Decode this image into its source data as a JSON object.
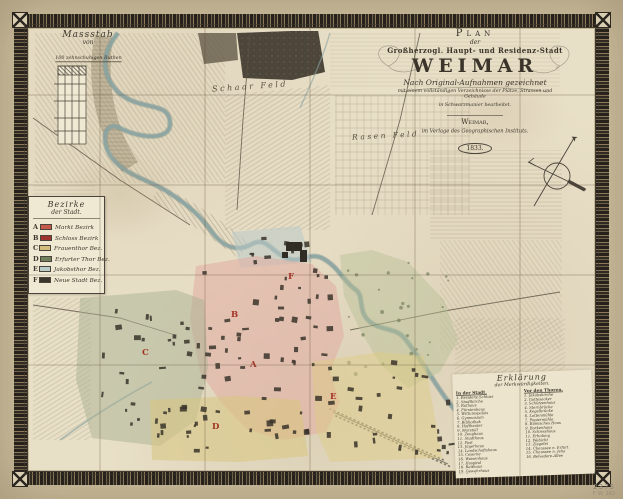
{
  "artifact": {
    "kind": "engraved city map, dissected and linen-backed, hand coloured",
    "sheet_size": "623x499"
  },
  "title_cartouche": {
    "plan_word": "Plan",
    "der_word": "der",
    "dedication": "Großherzogl. Haupt- und Residenz-Stadt",
    "city": "WEIMAR",
    "subtitle1": "Nach Original-Aufnahmen gezeichnet",
    "subtitle2": "mit einem vollständigen Verzeichnisse der Plätze, Strassen und Gebäude",
    "subtitle3": "in Schwarzmanier bearbeitet.",
    "publisher_city": "Weimar,",
    "publisher": "im Verlage des Geographischen Instituts.",
    "year": "1833."
  },
  "scale_panel": {
    "title": "Massstab",
    "subtitle": "von",
    "unit_line": "100 zehnschuhigen Ruthen"
  },
  "district_legend": {
    "header_line1": "Bezirke",
    "header_line2": "der Stadt.",
    "entries": [
      {
        "letter": "A",
        "color": "#c4584a",
        "name": "Markt Bezirk"
      },
      {
        "letter": "B",
        "color": "#9e3430",
        "name": "Schloss Bezirk"
      },
      {
        "letter": "C",
        "color": "#d2bd7c",
        "name": "Frauenthor Bez."
      },
      {
        "letter": "D",
        "color": "#70805a",
        "name": "Erfurter Thor Bez."
      },
      {
        "letter": "E",
        "color": "#b7cbc8",
        "name": "Jakobsthor Bez."
      },
      {
        "letter": "F",
        "color": "#3a352c",
        "name": "Neue Stadt Bez."
      }
    ]
  },
  "index_panel": {
    "title": "Erklärung",
    "subtitle": "der Merkwürdigkeiten.",
    "col1_header": "In der Stadt.",
    "col2_header": "Vor den Thoren.",
    "col1": [
      "Residenz-Schloss",
      "Stadtkirche",
      "Rathaus",
      "Fürstenhaus",
      "Wittumspalais",
      "Gymnasium",
      "Bibliothek",
      "Hoftheater",
      "Marstall",
      "Zeughaus",
      "Stadthaus",
      "Post",
      "Jägerhaus",
      "Landschaftshaus",
      "Caserne",
      "Waisenhaus",
      "Hospital",
      "Reithaus",
      "Gewehrhaus",
      "Brauhaus"
    ],
    "col2": [
      "Jakobskirche",
      "Gottesacker",
      "Schützenhaus",
      "Sternbrücke",
      "Kegelbrücke",
      "Lottenmühle",
      "Papiermühle",
      "Römisches Haus",
      "Borkenhaus",
      "Schiesshaus",
      "Erholung",
      "Webicht",
      "Ziegelei",
      "Chaussee n. Erfurt",
      "Chaussee n. Jena",
      "Belvedere-Allee"
    ]
  },
  "map_labels": {
    "field1": "Schaar Feld",
    "field2": "Rasen Feld"
  },
  "district_markers": [
    "A",
    "B",
    "C",
    "D",
    "E",
    "F"
  ],
  "margin_notes": {
    "number": "2375",
    "mark": "F. W. 182"
  },
  "colors": {
    "paper": "#e8dfc7",
    "mat": "#cfc2a1",
    "border_ink": "#2c2720",
    "water": "#8ba4a2",
    "park_green": "#b6bf95",
    "woods": "#4c453a",
    "marker_red": "#a33327"
  }
}
